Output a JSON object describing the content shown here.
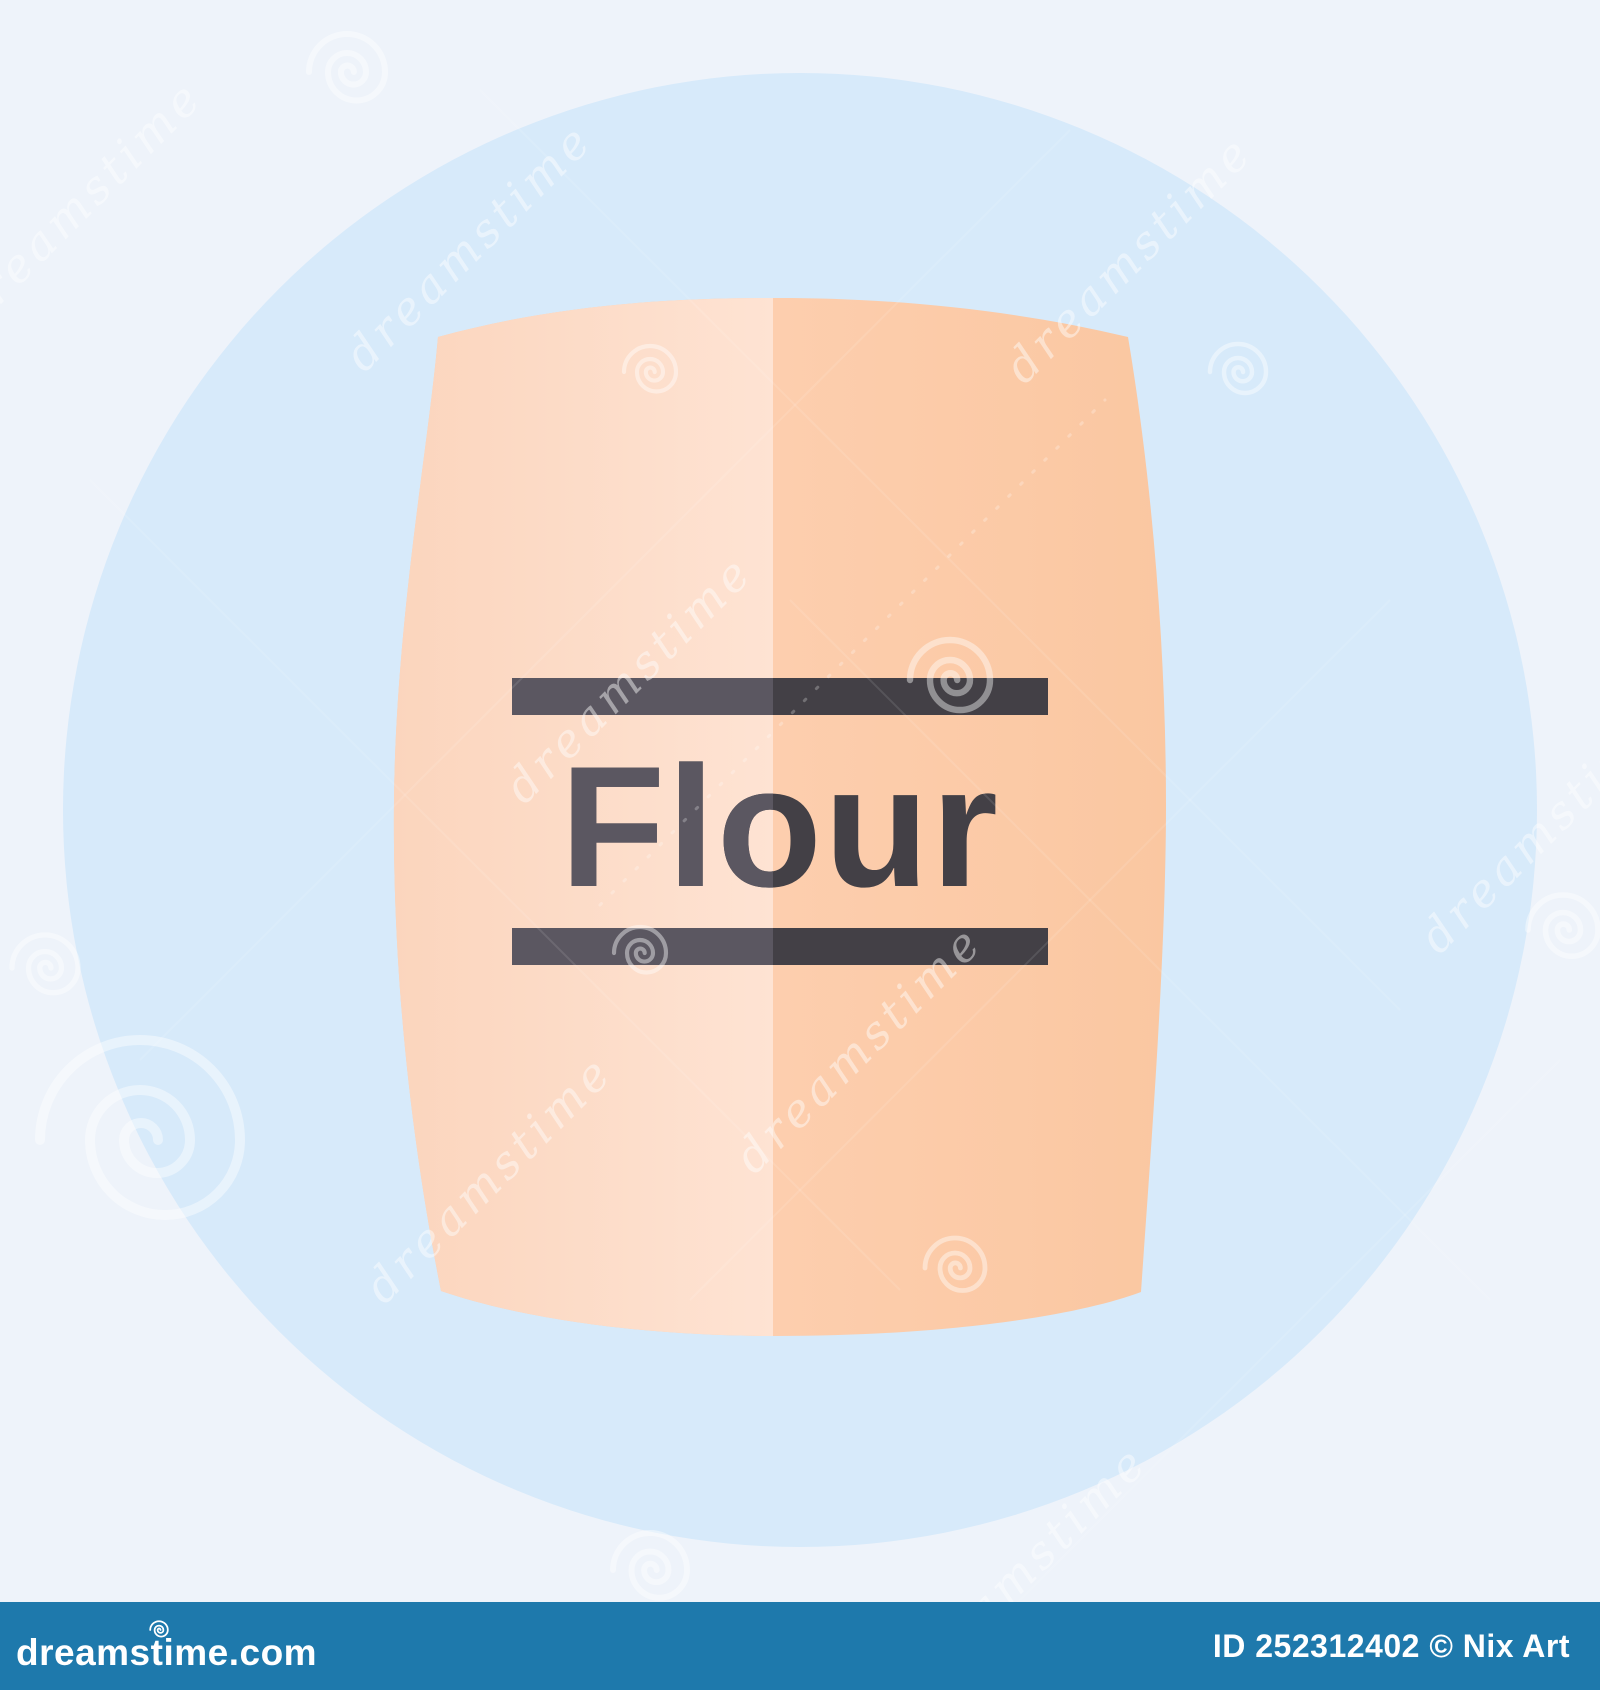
{
  "icon": {
    "label": "Flour"
  },
  "watermark": {
    "brand_text": "dreamstime",
    "spirals": [
      {
        "cx": 347,
        "cy": 72,
        "r": 38
      },
      {
        "cx": 1238,
        "cy": 372,
        "r": 28
      },
      {
        "cx": 650,
        "cy": 372,
        "r": 26
      },
      {
        "cx": 950,
        "cy": 680,
        "r": 40
      },
      {
        "cx": 640,
        "cy": 953,
        "r": 26
      },
      {
        "cx": 955,
        "cy": 1268,
        "r": 30
      },
      {
        "cx": 650,
        "cy": 1570,
        "r": 37
      },
      {
        "cx": 45,
        "cy": 968,
        "r": 33
      },
      {
        "cx": 140,
        "cy": 1140,
        "r": 100,
        "sw": 0.1
      },
      {
        "cx": 1563,
        "cy": 930,
        "r": 35
      }
    ],
    "texts": [
      {
        "x": 90,
        "y": 215
      },
      {
        "x": 480,
        "y": 258
      },
      {
        "x": 1140,
        "y": 270
      },
      {
        "x": 640,
        "y": 690
      },
      {
        "x": 500,
        "y": 1190
      },
      {
        "x": 870,
        "y": 1060
      },
      {
        "x": 1555,
        "y": 840
      },
      {
        "x": 1035,
        "y": 1580
      }
    ]
  },
  "footer": {
    "logo_pre": "dreams",
    "logo_t": "t",
    "logo_post": "ime.com",
    "credit": "ID 252312402 © Nix Art"
  },
  "colors": {
    "background": "#eef3fa",
    "circle": "#d7eafa",
    "bag_left_a": "#fbd5bd",
    "bag_left_b": "#fee3d3",
    "bag_right_a": "#fdceae",
    "bag_right_b": "#fac7a1",
    "ink_dark": "#434046",
    "ink_light": "#5b5761",
    "footer_blue": "#1e79ac",
    "watermark_white": "#ffffff"
  }
}
